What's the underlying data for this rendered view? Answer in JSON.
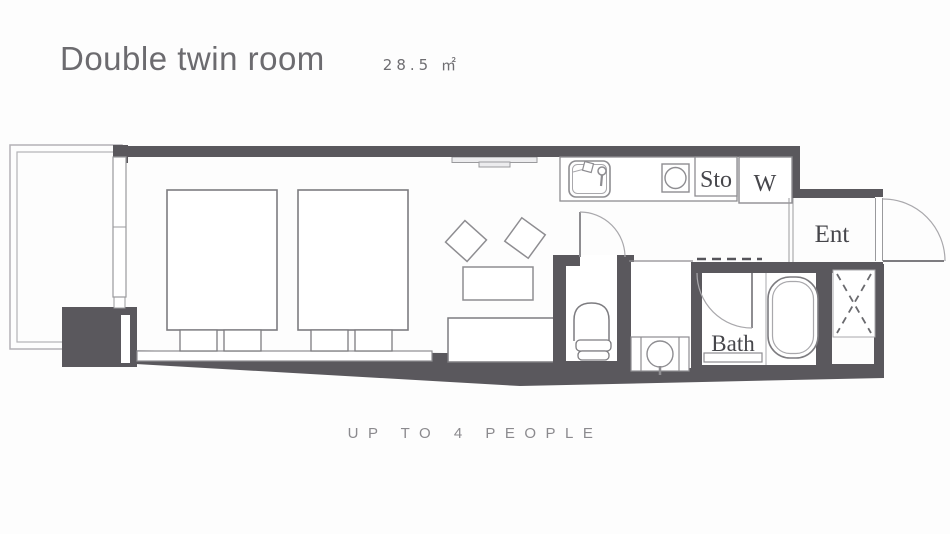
{
  "header": {
    "title": "Double twin room",
    "area": "28.5 ㎡"
  },
  "plan": {
    "rooms": {
      "storage": "Sto",
      "washer": "W",
      "entrance": "Ent",
      "bath": "Bath"
    }
  },
  "footer": {
    "capacity": "UP TO 4 PEOPLE"
  },
  "colors": {
    "wall": "#5a585d",
    "fixture_line": "#8e8d91",
    "furniture_line": "#7d7c80",
    "light_line": "#a9a8ac",
    "title_text": "#6c6b6f",
    "capacity_text": "#8b8a8e",
    "label_text": "#46464b"
  }
}
